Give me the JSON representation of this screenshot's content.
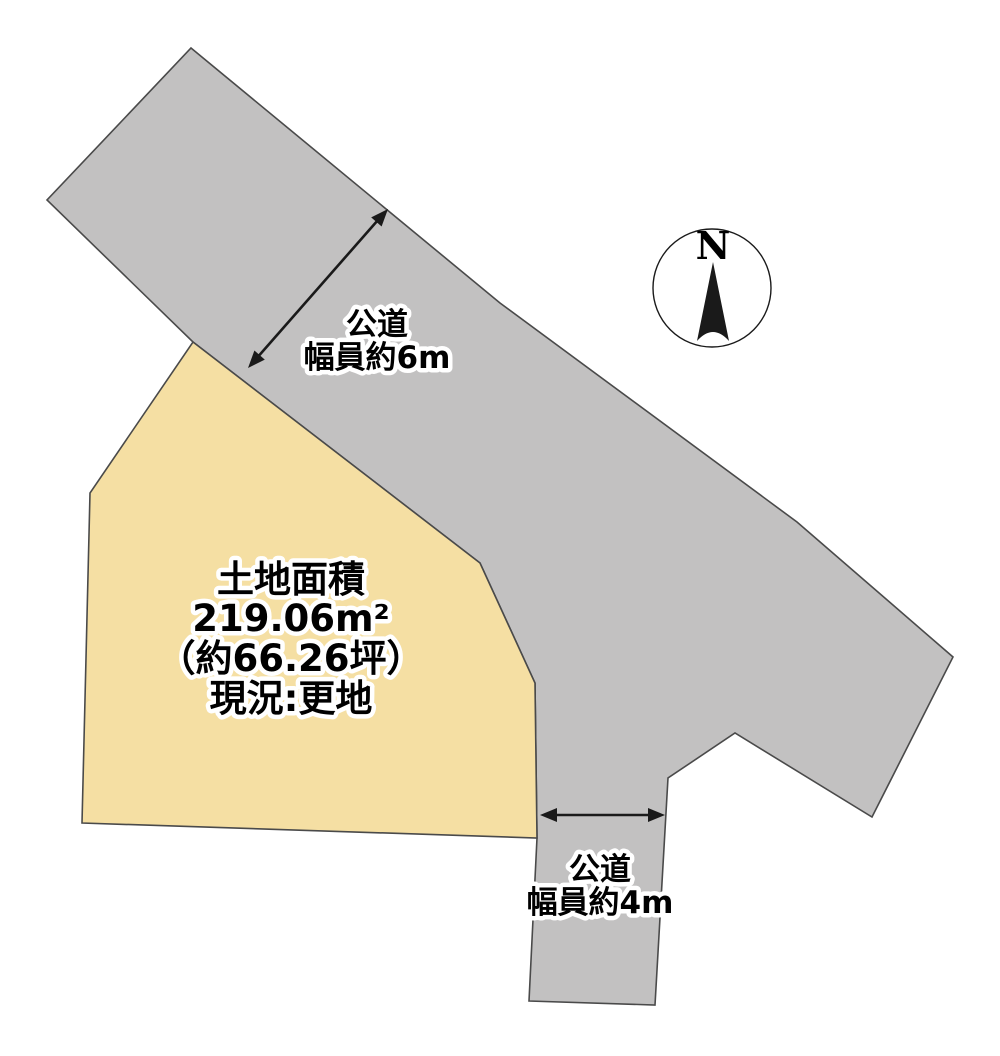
{
  "diagram_title": "land-plot-layout-diagram",
  "colors": {
    "background": "#ffffff",
    "road_fill": "#c2c1c1",
    "parcel_fill": "#f5dfa3",
    "outline": "#4a4a4a",
    "arrow": "#1a1a1a",
    "compass_fill": "#ffffff",
    "compass_stroke": "#1a1a1a"
  },
  "parcel": {
    "area_title": "土地面積",
    "area_sqm": "219.06m²",
    "area_tsubo": "（約66.26坪）",
    "current_state": "現況:更地"
  },
  "main_road": {
    "name": "公道",
    "width_note": "幅員約6m"
  },
  "side_road": {
    "name": "公道",
    "width_note": "幅員約4m"
  },
  "compass": {
    "north_label": "N"
  }
}
